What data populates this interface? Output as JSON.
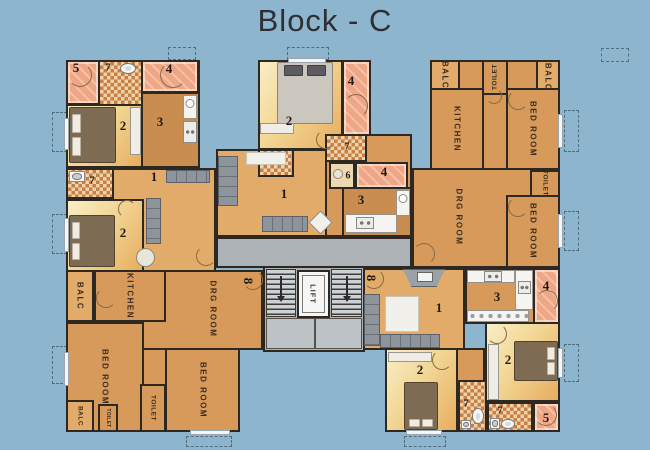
{
  "title": "Block - C",
  "labels": {
    "balc": "BALC",
    "kitchen": "KITCHEN",
    "bed_room": "BED ROOM",
    "drg_room": "DRG ROOM",
    "toilet": "TOILET",
    "lift": "LIFT"
  },
  "numbers": {
    "living": "1",
    "bedroom": "2",
    "kitchen": "3",
    "balcony": "4",
    "balcony_small": "5",
    "wash": "6",
    "toilet": "7",
    "staircase": "8"
  },
  "colors": {
    "background": "#8db6ce",
    "wall": "#2e2822",
    "room_orange": "#d79a5b",
    "room_orange_light": "#e3ab69",
    "kitchen_tan": "#c98e4f",
    "bedroom_yellow": "#f2d694",
    "balcony_pink": "#efa685",
    "toilet_checker": "#c97f43",
    "corridor_gray": "#adb2b6",
    "stair_gray": "#ccd1d4"
  }
}
